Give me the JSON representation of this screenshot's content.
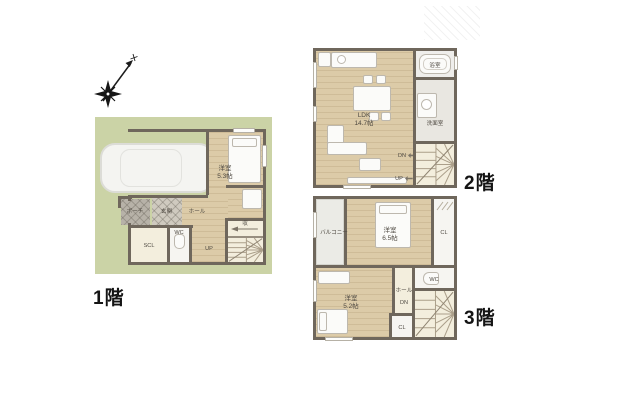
{
  "floors": {
    "f1": {
      "title": "1階",
      "labels": {
        "bedroom": "洋室",
        "bedroom_size": "5.3帖",
        "porch": "ポーチ",
        "genkan": "玄関",
        "hall": "ホール",
        "scl": "SCL",
        "wc": "WC",
        "up": "UP",
        "storage": "収"
      }
    },
    "f2": {
      "title": "2階",
      "labels": {
        "ldk": "LDK",
        "ldk_size": "14.7帖",
        "bath": "浴室",
        "washroom": "洗面室",
        "dn": "DN",
        "up": "UP"
      }
    },
    "f3": {
      "title": "3階",
      "labels": {
        "balcony": "バルコニー",
        "bedroom_main": "洋室",
        "bedroom_main_size": "6.5帖",
        "closet_upper": "CL",
        "wc": "WC",
        "hall": "ホール",
        "dn": "DN",
        "closet_lower": "CL",
        "bedroom_sub": "洋室",
        "bedroom_sub_size": "5.2帖"
      }
    }
  },
  "colors": {
    "lawn": "#cbd3a6",
    "wood": "#dccba8",
    "wall": "#6f675c",
    "cream": "#f3eedd",
    "label_text": "#4f4a42"
  }
}
